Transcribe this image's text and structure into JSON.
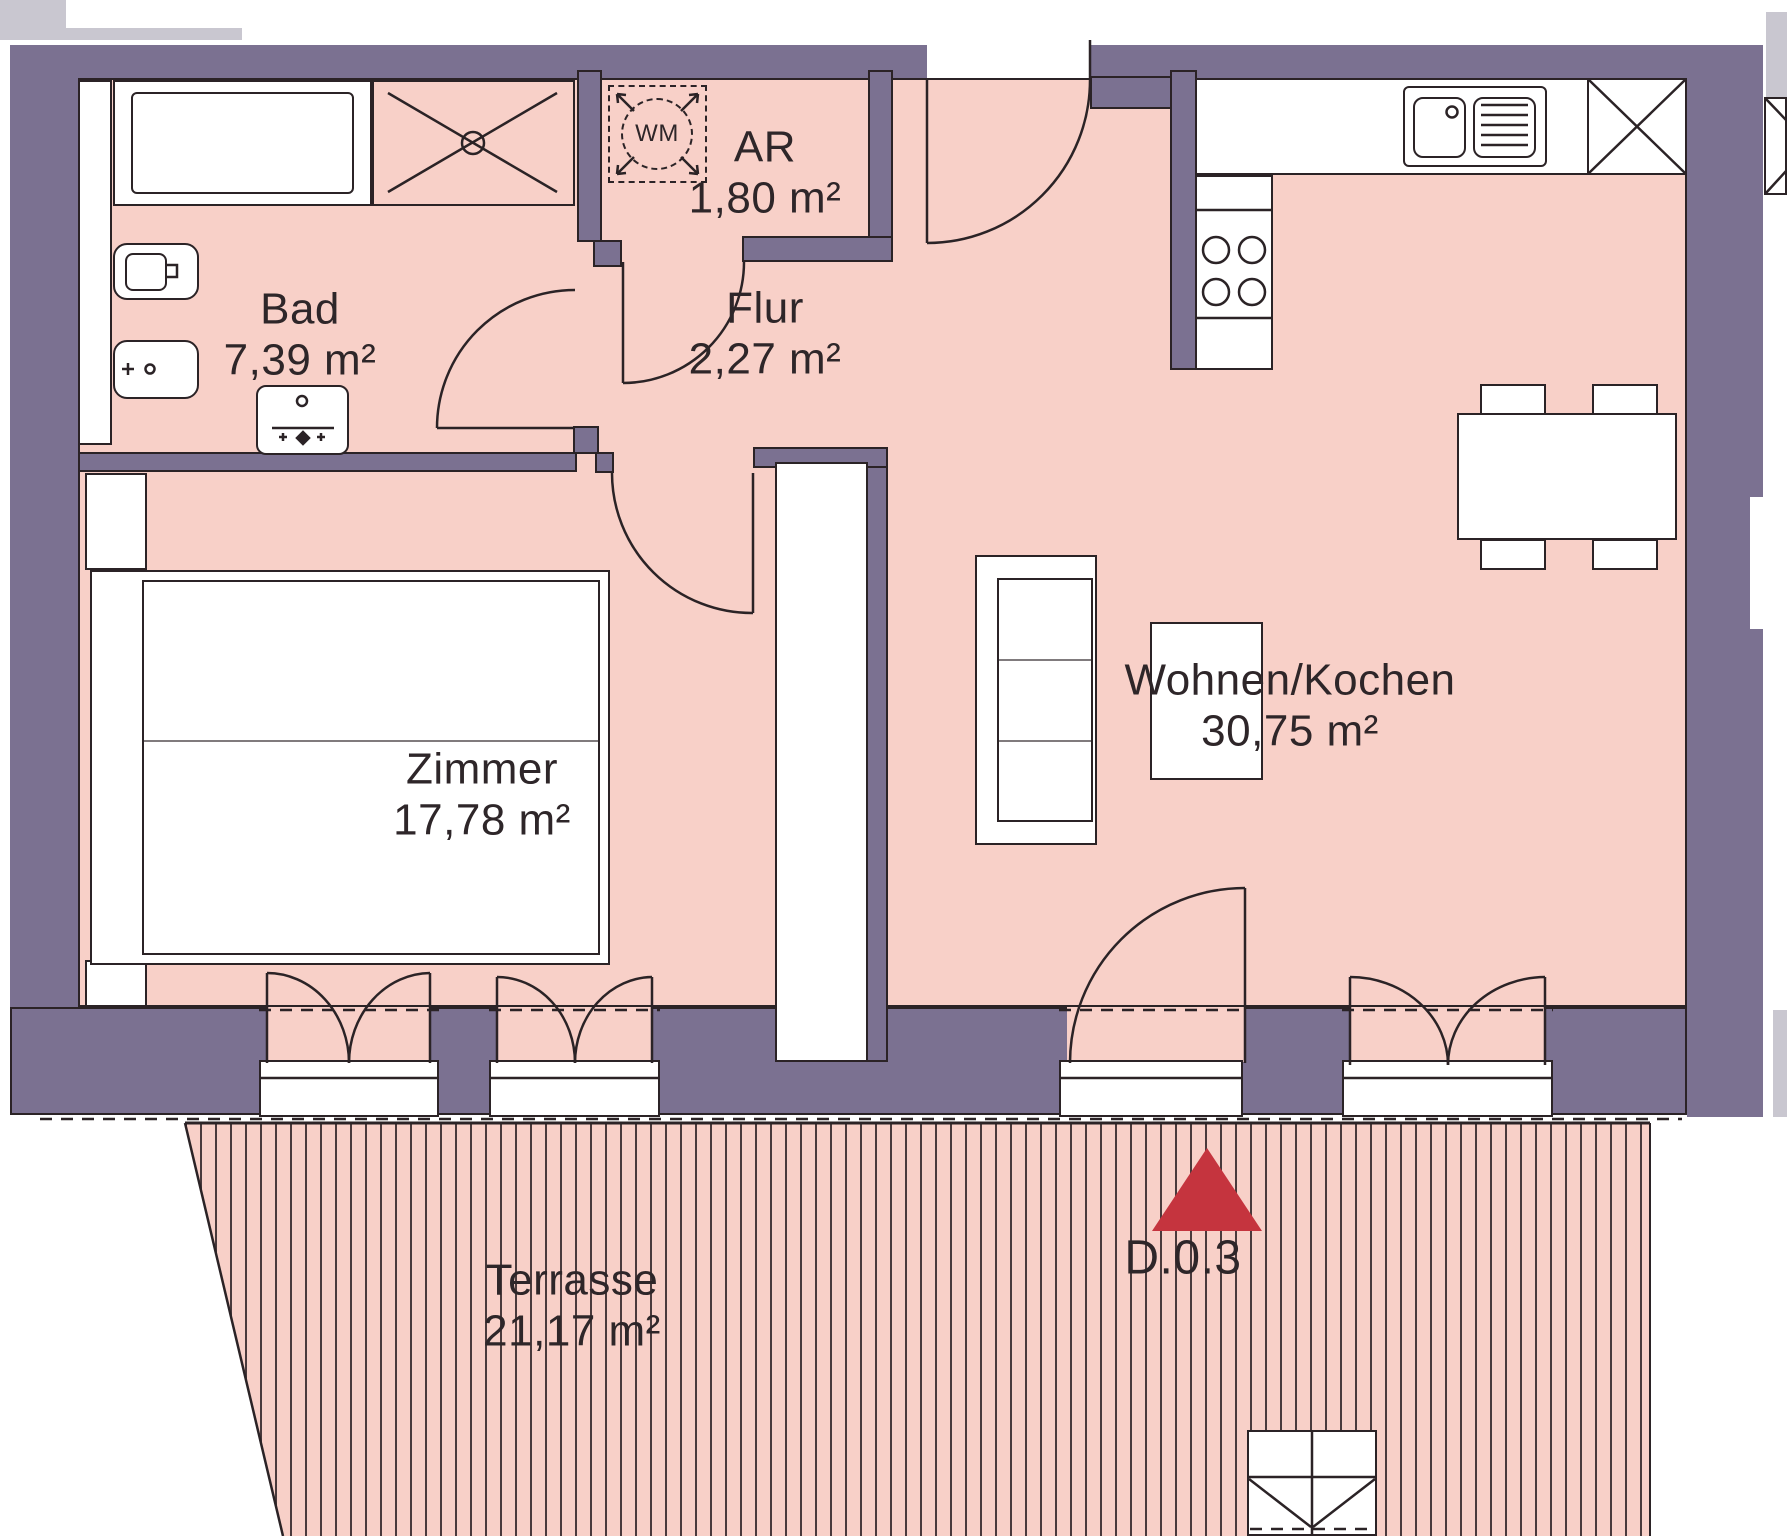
{
  "plan": {
    "unit_label": "D.0.3",
    "washing_machine_label": "WM",
    "rooms": [
      {
        "id": "bad",
        "name": "Bad",
        "area": "7,39 m²"
      },
      {
        "id": "ar",
        "name": "AR",
        "area": "1,80 m²"
      },
      {
        "id": "flur",
        "name": "Flur",
        "area": "2,27 m²"
      },
      {
        "id": "zimmer",
        "name": "Zimmer",
        "area": "17,78 m²"
      },
      {
        "id": "wohnen_kochen",
        "name": "Wohnen/Kochen",
        "area": "30,75 m²"
      },
      {
        "id": "terrasse",
        "name": "Terrasse",
        "area": "21,17 m²"
      }
    ],
    "colors": {
      "wall": "#7b7191",
      "room_fill": "#f8d0c8",
      "line": "#2b2326",
      "marker_red": "#c5343e",
      "neighbor_gray": "#c9c7d0",
      "hatch": "#4a3a3c"
    }
  }
}
